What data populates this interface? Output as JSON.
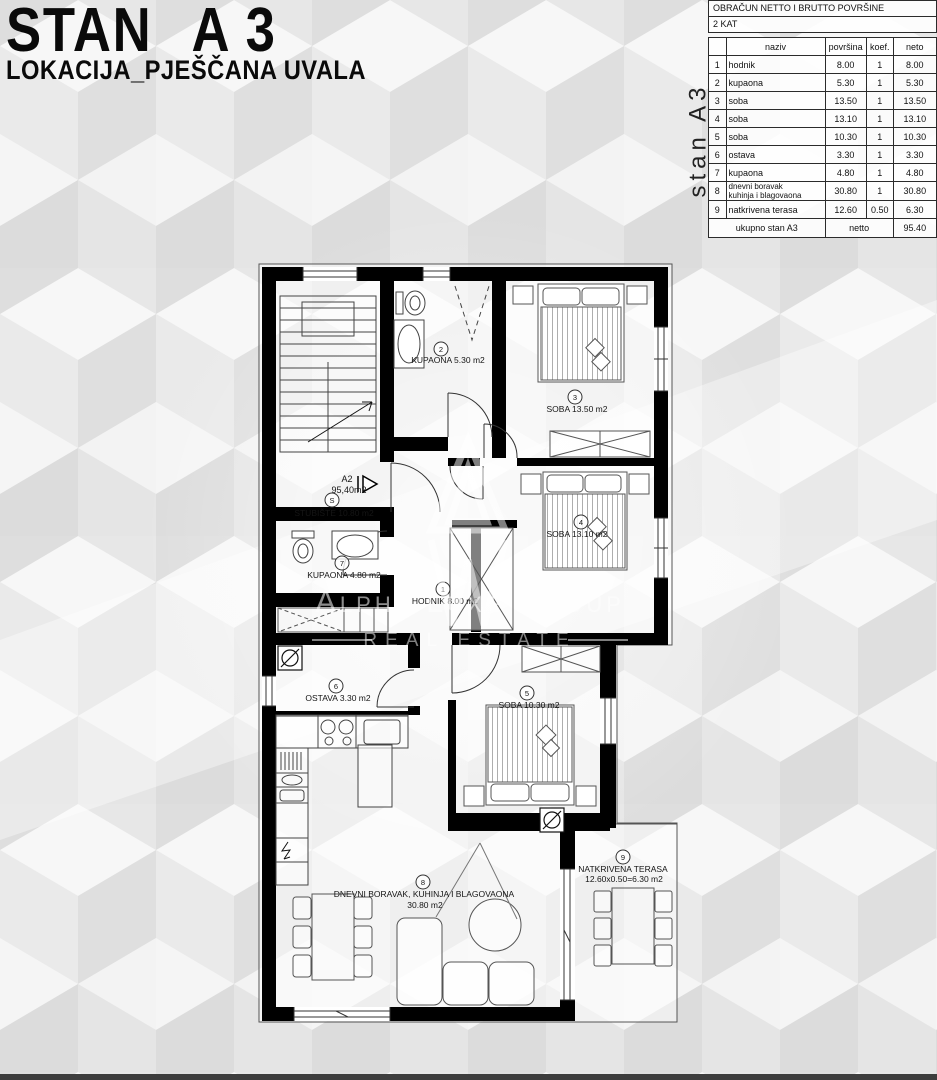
{
  "header": {
    "title_left": "STAN",
    "title_right": "A 3",
    "subtitle": "LOKACIJA_PJEŠČANA UVALA"
  },
  "summary_table": {
    "title": "OBRAČUN NETTO I BRUTTO POVRŠINE",
    "floor": "2 KAT",
    "side_label": "stan A3",
    "columns": {
      "naziv": "naziv",
      "povrsina": "površina",
      "koef": "koef.",
      "neto": "neto"
    },
    "rows": [
      {
        "num": "1",
        "naziv": "hodnik",
        "povrsina": "8.00",
        "koef": "1",
        "neto": "8.00"
      },
      {
        "num": "2",
        "naziv": "kupaona",
        "povrsina": "5.30",
        "koef": "1",
        "neto": "5.30"
      },
      {
        "num": "3",
        "naziv": "soba",
        "povrsina": "13.50",
        "koef": "1",
        "neto": "13.50"
      },
      {
        "num": "4",
        "naziv": "soba",
        "povrsina": "13.10",
        "koef": "1",
        "neto": "13.10"
      },
      {
        "num": "5",
        "naziv": "soba",
        "povrsina": "10.30",
        "koef": "1",
        "neto": "10.30"
      },
      {
        "num": "6",
        "naziv": "ostava",
        "povrsina": "3.30",
        "koef": "1",
        "neto": "3.30"
      },
      {
        "num": "7",
        "naziv": "kupaona",
        "povrsina": "4.80",
        "koef": "1",
        "neto": "4.80"
      },
      {
        "num": "8",
        "naziv": "dnevni boravak",
        "naziv2": "kuhinja i blagovaona",
        "povrsina": "30.80",
        "koef": "1",
        "neto": "30.80"
      },
      {
        "num": "9",
        "naziv": "natkrivena terasa",
        "povrsina": "12.60",
        "koef": "0.50",
        "neto": "6.30"
      }
    ],
    "total": {
      "label": "ukupno stan A3",
      "mode": "netto",
      "value": "95.40"
    }
  },
  "plan": {
    "apartment_code": "A2",
    "apartment_area": "95,40m2",
    "rooms": [
      {
        "num": "S",
        "label": "STUBIŠTE 10.80 m2"
      },
      {
        "num": "1",
        "label": "HODNIK 8.00 m2"
      },
      {
        "num": "2",
        "label": "KUPAONA 5.30 m2"
      },
      {
        "num": "3",
        "label": "SOBA 13.50 m2"
      },
      {
        "num": "4",
        "label": "SOBA 13.10 m2"
      },
      {
        "num": "5",
        "label": "SOBA 10.30 m2"
      },
      {
        "num": "6",
        "label": "OSTAVA 3.30 m2"
      },
      {
        "num": "7",
        "label": "KUPAONA 4.80 m2"
      },
      {
        "num": "8",
        "label": "DNEVNI BORAVAK, KUHINJA I BLAGOVAONA",
        "label2": "30.80 m2"
      },
      {
        "num": "9",
        "label": "NATKRIVENA TERASA",
        "label2": "12.60x0.50=6.30 m2"
      }
    ]
  },
  "watermark": {
    "brand": "Alpha Luxe Group",
    "tagline": "REAL ESTATE"
  },
  "colors": {
    "wall": "#000000",
    "line": "#444444",
    "pattern_light": "#f6f6f6",
    "pattern_mid": "#e9e9e9",
    "pattern_dark": "#dcdcdc"
  }
}
